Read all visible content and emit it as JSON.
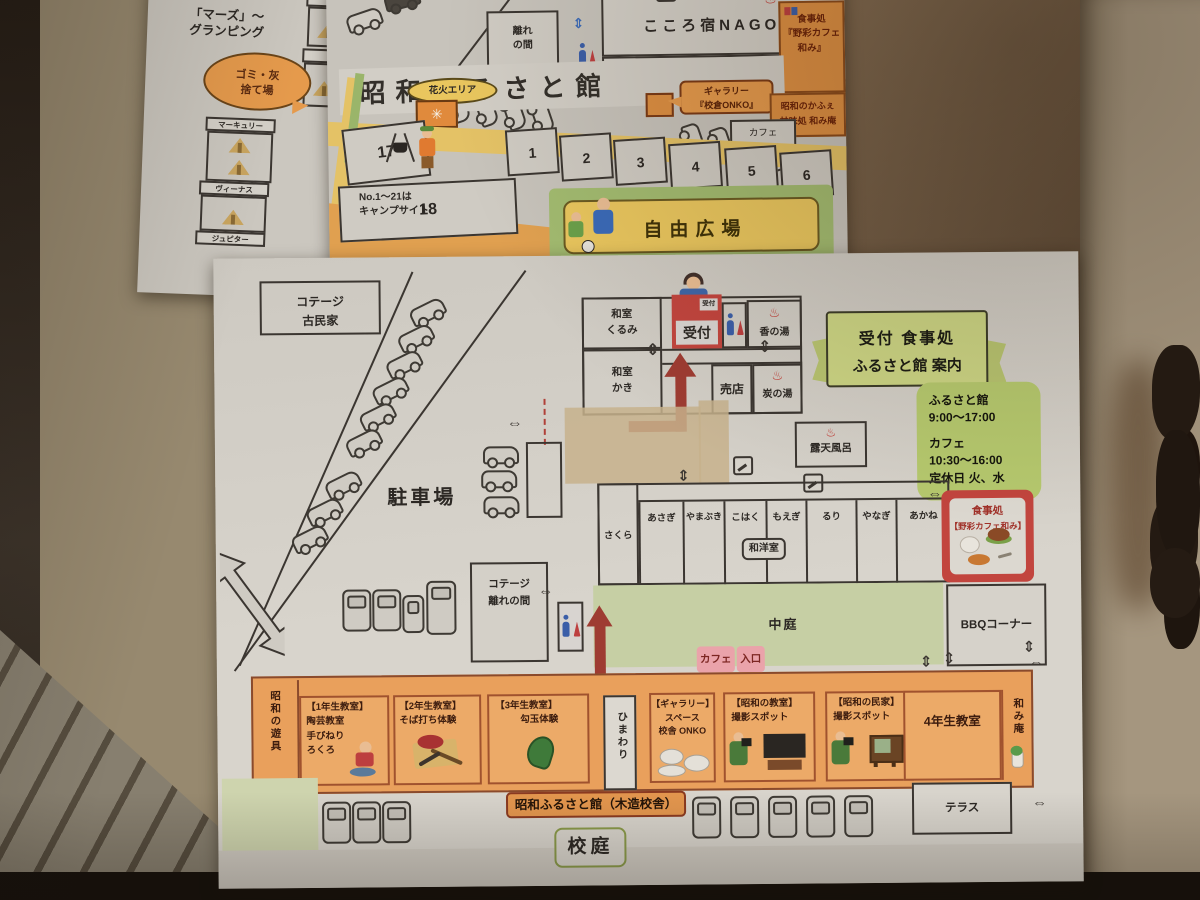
{
  "colors": {
    "arrow_red": "#9e3c32",
    "building_orange": "#e9a05c",
    "banner_green": "#ccd584",
    "hours_green": "#b6c96e",
    "box_red": "#c2453e",
    "entrance_pink": "#eaa3aa"
  },
  "glamping_paper": {
    "title_line1": "「マーズ」〜",
    "title_line2": "グランピング",
    "bubble_line1": "ゴミ・灰",
    "bubble_line2": "捨て場",
    "sites": [
      "マーキュリー",
      "ヴィーナス",
      "ジュピター"
    ]
  },
  "camp_paper": {
    "hanare_line1": "離れ",
    "hanare_line2": "の間",
    "nagomi_title": "こころ宿NAGOMI",
    "karesansui": "枯山水『栃木の庭』",
    "restaurant_line1": "食事処",
    "restaurant_line2": "『野彩カフェ",
    "restaurant_line3": "和み』",
    "facility_title": "昭和ふるさと館",
    "gallery_line1": "ギャラリー",
    "gallery_line2": "『校倉ONKO』",
    "sweets_line1": "昭和のかふぇ",
    "sweets_line2": "甘味処 和み庵",
    "cafe_terrace_line1": "カフェ",
    "cafe_terrace_line2": "テラス席",
    "fireworks_label": "花火エリア",
    "note_line1": "No.1〜21は",
    "note_line2": "キャンプサイト",
    "site_numbers": [
      "17",
      "18",
      "1",
      "2",
      "3",
      "4",
      "5",
      "6"
    ],
    "plaza": "自由広場"
  },
  "facility_paper": {
    "cottage_kominka_line1": "コテージ",
    "cottage_kominka_line2": "古民家",
    "parking": "駐車場",
    "room_kurumi_line1": "和室",
    "room_kurumi_line2": "くるみ",
    "room_kaki_line1": "和室",
    "room_kaki_line2": "かき",
    "reception": "受付",
    "reception_tag": "受付",
    "bath_kaori": "香の湯",
    "shop": "売店",
    "bath_sumi": "炭の湯",
    "banner_line1": "受付 食事処",
    "banner_line2": "ふるさと館 案内",
    "hours": {
      "facility_name": "ふるさと館",
      "facility_time": "9:00〜17:00",
      "cafe_name": "カフェ",
      "cafe_time": "10:30〜16:00",
      "closed": "定休日 火、水"
    },
    "open_air_bath": "露天風呂",
    "rooms": [
      "さくら",
      "あさぎ",
      "やまぶき",
      "こはく",
      "もえぎ",
      "るり",
      "やなぎ",
      "あかね"
    ],
    "wayo_room": "和洋室",
    "cafe_restaurant_line1": "食事処",
    "cafe_restaurant_line2": "【野彩カフェ和み】",
    "cottage_hanare_line1": "コテージ",
    "cottage_hanare_line2": "離れの間",
    "courtyard": "中庭",
    "bbq": "BBQコーナー",
    "cafe_entrance_word1": "カフェ",
    "cafe_entrance_word2": "入口",
    "playground_equip": "昭和の遊具",
    "classroom1_line1": "【1年生教室】",
    "classroom1_line2": "陶芸教室",
    "classroom1_line3": "手びねり",
    "classroom1_line4": "ろくろ",
    "classroom2_line1": "【2年生教室】",
    "classroom2_line2": "そば打ち体験",
    "classroom3_line1": "【3年生教室】",
    "classroom3_line2": "勾玉体験",
    "himawari": "ひまわり",
    "gallery_line1": "【ギャラリー】",
    "gallery_line2": "スペース",
    "gallery_line3": "校舎 ONKO",
    "photo_classroom_line1": "【昭和の教室】",
    "photo_classroom_line2": "撮影スポット",
    "photo_minka_line1": "【昭和の民家】",
    "photo_minka_line2": "撮影スポット",
    "classroom4": "4年生教室",
    "nagomian": "和み庵",
    "terrace": "テラス",
    "building_label": "昭和ふるさと館（木造校舎）",
    "schoolyard": "校庭"
  }
}
